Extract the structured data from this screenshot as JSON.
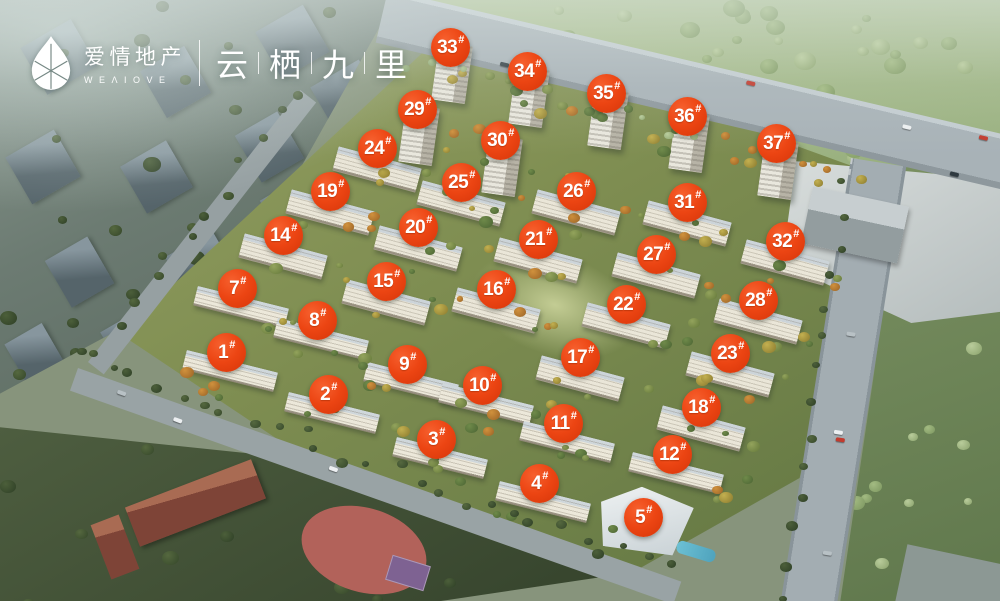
{
  "header": {
    "logo": {
      "icon": "water-drop-logo",
      "brand_cn": "爱情地产",
      "brand_en": "WEΛIOVE"
    },
    "project_title": {
      "text": "云栖九里",
      "chars": [
        "云",
        "栖",
        "九",
        "里"
      ],
      "separator": "|"
    }
  },
  "map": {
    "marker_suffix": "#",
    "marker_color": "#e8430f",
    "marker_highlight_color": "#f6602e",
    "marker_text_color": "#ffffff",
    "markers": [
      {
        "label": "1",
        "x": 22.7,
        "y": 58.7
      },
      {
        "label": "2",
        "x": 32.9,
        "y": 65.7
      },
      {
        "label": "3",
        "x": 43.7,
        "y": 73.2
      },
      {
        "label": "4",
        "x": 54.0,
        "y": 80.5
      },
      {
        "label": "5",
        "x": 64.4,
        "y": 86.2
      },
      {
        "label": "7",
        "x": 23.8,
        "y": 48.1
      },
      {
        "label": "8",
        "x": 31.8,
        "y": 53.4
      },
      {
        "label": "9",
        "x": 40.8,
        "y": 60.7
      },
      {
        "label": "10",
        "x": 48.3,
        "y": 64.2
      },
      {
        "label": "11",
        "x": 56.4,
        "y": 70.5
      },
      {
        "label": "12",
        "x": 67.3,
        "y": 75.7
      },
      {
        "label": "14",
        "x": 28.4,
        "y": 39.3
      },
      {
        "label": "15",
        "x": 38.7,
        "y": 46.9
      },
      {
        "label": "16",
        "x": 49.7,
        "y": 48.3
      },
      {
        "label": "17",
        "x": 58.1,
        "y": 59.6
      },
      {
        "label": "18",
        "x": 70.2,
        "y": 67.9
      },
      {
        "label": "19",
        "x": 33.1,
        "y": 32.0
      },
      {
        "label": "20",
        "x": 41.9,
        "y": 37.9
      },
      {
        "label": "21",
        "x": 53.9,
        "y": 39.9
      },
      {
        "label": "22",
        "x": 62.7,
        "y": 50.7
      },
      {
        "label": "23",
        "x": 73.1,
        "y": 58.9
      },
      {
        "label": "24",
        "x": 37.8,
        "y": 24.8
      },
      {
        "label": "25",
        "x": 46.2,
        "y": 30.4
      },
      {
        "label": "26",
        "x": 57.7,
        "y": 31.9
      },
      {
        "label": "27",
        "x": 65.7,
        "y": 42.4
      },
      {
        "label": "28",
        "x": 75.9,
        "y": 50.1
      },
      {
        "label": "29",
        "x": 41.8,
        "y": 18.3
      },
      {
        "label": "30",
        "x": 50.1,
        "y": 23.5
      },
      {
        "label": "31",
        "x": 68.8,
        "y": 33.8
      },
      {
        "label": "32",
        "x": 78.6,
        "y": 40.3
      },
      {
        "label": "33",
        "x": 45.1,
        "y": 8.0
      },
      {
        "label": "34",
        "x": 52.8,
        "y": 12.0
      },
      {
        "label": "35",
        "x": 60.7,
        "y": 15.6
      },
      {
        "label": "36",
        "x": 68.8,
        "y": 19.5
      },
      {
        "label": "37",
        "x": 77.7,
        "y": 24.0
      }
    ]
  },
  "scene_colors": {
    "lawn": "#7e8d51",
    "forest": "#a9bd92",
    "road": "#a5aeb1",
    "city": "#6c7b72",
    "school_track": "#b2625a",
    "pool_water": "#5fb0c8",
    "building_facade": "#ece8da"
  }
}
